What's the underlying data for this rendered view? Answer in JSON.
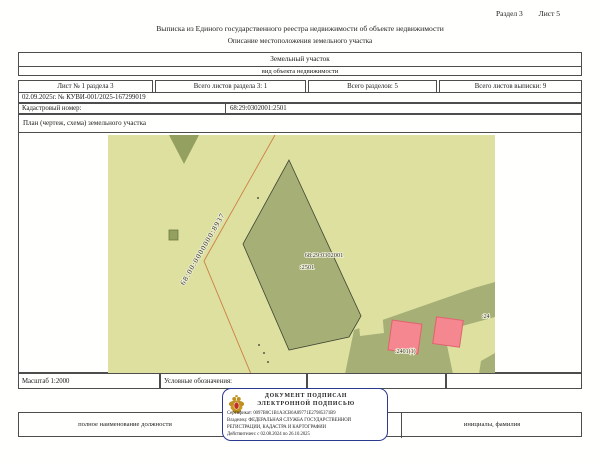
{
  "page": {
    "section_label": "Раздел 3",
    "sheet_label": "Лист 5",
    "title": "Выписка из Единого государственного реестра недвижимости об объекте недвижимости",
    "subtitle": "Описание местоположения земельного участка"
  },
  "object_type": {
    "name": "Земельный участок",
    "caption": "вид объекта недвижимости"
  },
  "sheet_info": {
    "cells": [
      "Лист № 1 раздела 3",
      "Всего листов раздела 3: 1",
      "Всего разделов: 5",
      "Всего листов выписки: 9"
    ]
  },
  "document_number": "02.09.2025г. № КУВИ-001/2025-167299019",
  "cadastral": {
    "label": "Кадастровый номер:",
    "value": "68:29:0302001:2501"
  },
  "plan": {
    "header": "План (чертеж, схема) земельного участка",
    "labels": {
      "boundary_line": "68:00:0000000:8937",
      "parcel_line1": "68:29:0302001",
      "parcel_line2": ":2501",
      "neighbor": ":2401(1)",
      "edge_partial": ":24"
    },
    "colors": {
      "map_bg": "#dde09f",
      "parcel_fill": "#a6af76",
      "vegetation_fill": "#94a05f",
      "building_fill": "#f4878f",
      "building_stroke": "#e0636e",
      "boundary_line": "#cc7f42"
    }
  },
  "footer": {
    "scale": "Масштаб 1:2000",
    "legend_label": "Условные обозначения:",
    "position_label": "полное наименование должности",
    "name_label": "инициалы, фамилия"
  },
  "stamp": {
    "line1": "ДОКУМЕНТ ПОДПИСАН",
    "line2": "ЭЛЕКТРОННОЙ ПОДПИСЬЮ",
    "certificate": "Сертификат: 0097B0C1B1A3CB6A89771E27985371B9",
    "owner": "Владелец: ФЕДЕРАЛЬНАЯ СЛУЖБА ГОСУДАРСТВЕННОЙ",
    "owner2": "РЕГИСТРАЦИИ, КАДАСТРА И КАРТОГРАФИИ",
    "validity": "Действителен: с 02.08.2024 по 26.10.2025",
    "border_color": "#2c3a8e"
  }
}
